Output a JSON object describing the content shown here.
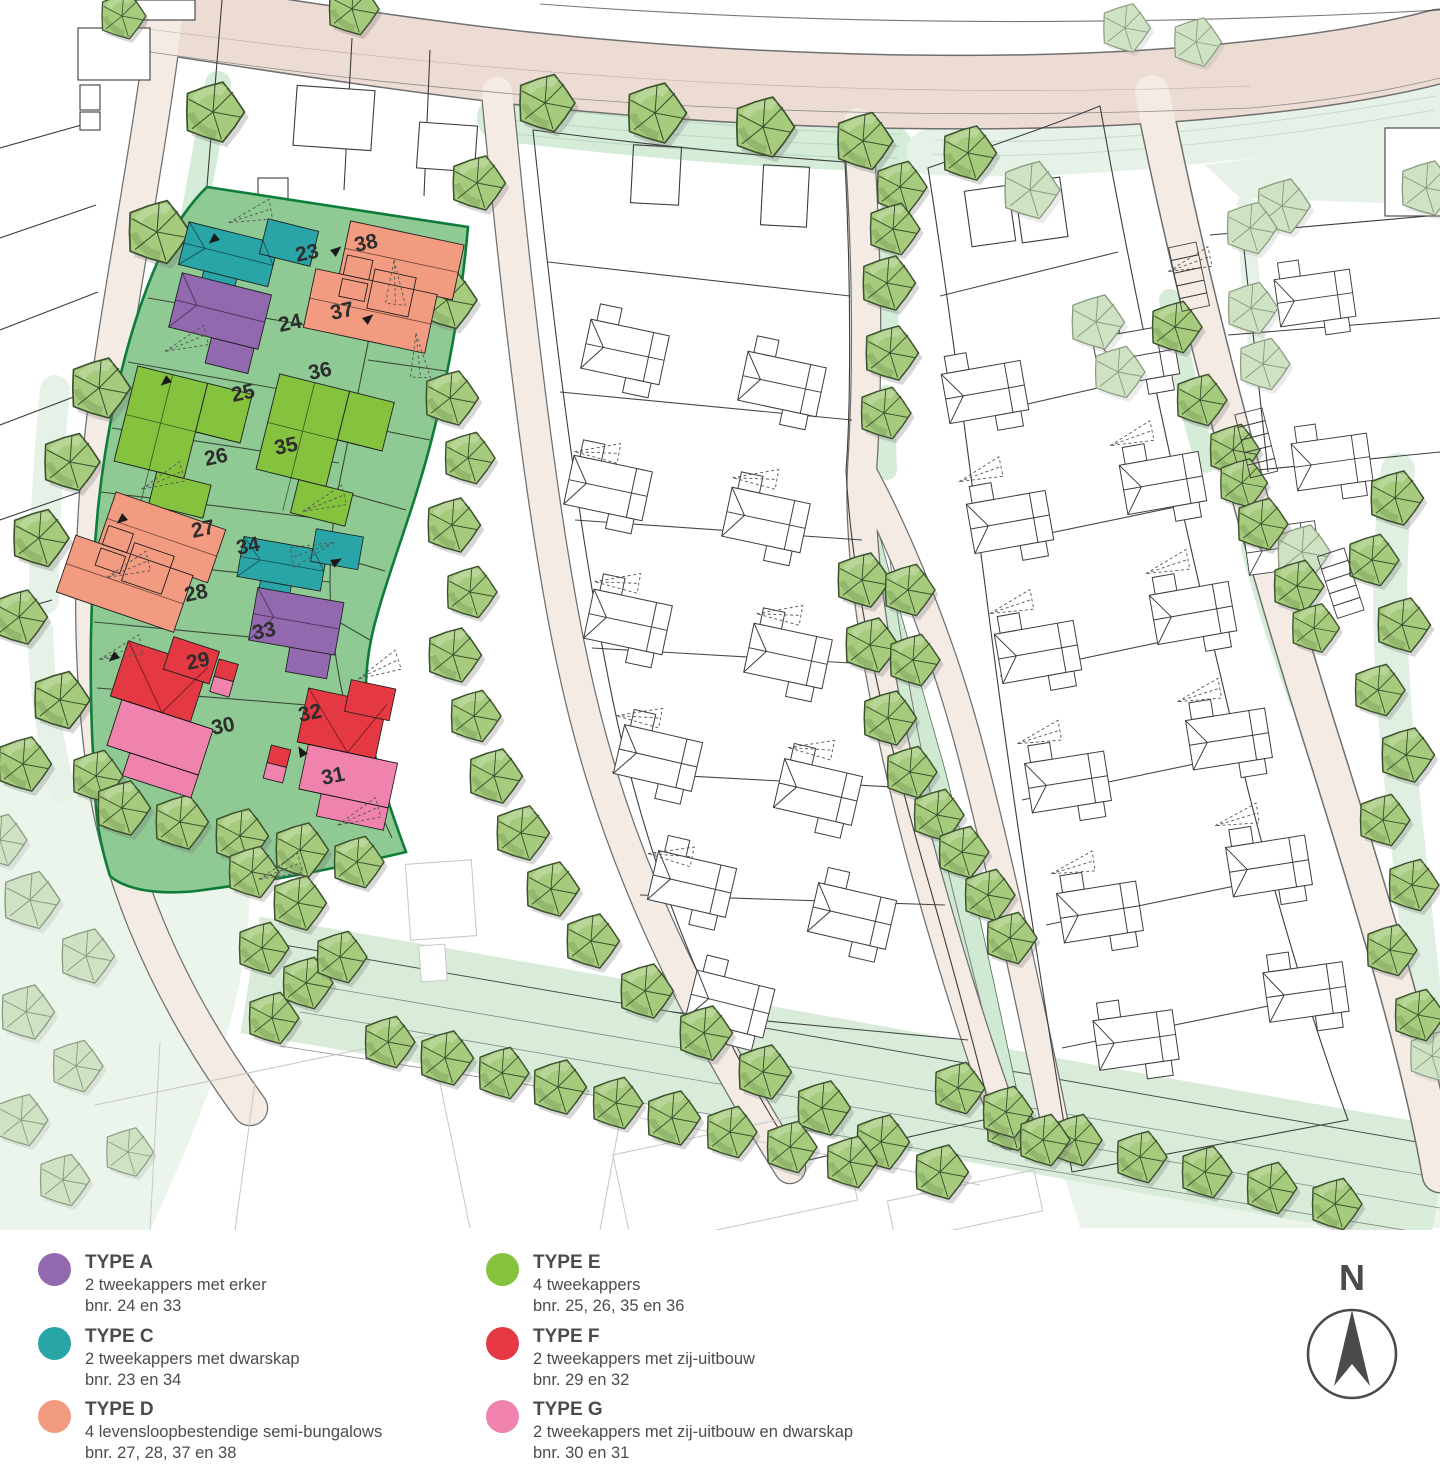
{
  "map": {
    "colors": {
      "type_a": "#9268af",
      "type_c": "#29a5a8",
      "type_d": "#f29b80",
      "type_e": "#85c23e",
      "type_f": "#e43843",
      "type_g": "#f083ae",
      "parcel": "#8fc993",
      "parcel_border": "#0e7c3a",
      "tree": "#a6cb7d",
      "tree_pale": "#d0e2c4",
      "road_main": "#eddcd4",
      "road": "#f4ebe5",
      "verge": "#d5ecd8",
      "verge_pale": "#e6f2e7",
      "corridor": "#d9ecd9",
      "park": "#cfe9d2",
      "bg_pale": "#ecf5ec"
    },
    "lot_numbers": [
      {
        "n": "23",
        "x": 297,
        "y": 262,
        "r": -12
      },
      {
        "n": "24",
        "x": 280,
        "y": 332,
        "r": -12
      },
      {
        "n": "25",
        "x": 233,
        "y": 402,
        "r": -12
      },
      {
        "n": "26",
        "x": 206,
        "y": 466,
        "r": -12
      },
      {
        "n": "27",
        "x": 193,
        "y": 538,
        "r": -12
      },
      {
        "n": "28",
        "x": 186,
        "y": 602,
        "r": -12
      },
      {
        "n": "29",
        "x": 188,
        "y": 670,
        "r": -12
      },
      {
        "n": "30",
        "x": 213,
        "y": 735,
        "r": -12
      },
      {
        "n": "31",
        "x": 323,
        "y": 785,
        "r": -12
      },
      {
        "n": "32",
        "x": 300,
        "y": 722,
        "r": -12
      },
      {
        "n": "33",
        "x": 254,
        "y": 640,
        "r": -12
      },
      {
        "n": "34",
        "x": 238,
        "y": 555,
        "r": -12
      },
      {
        "n": "35",
        "x": 276,
        "y": 455,
        "r": -12
      },
      {
        "n": "36",
        "x": 310,
        "y": 380,
        "r": -12
      },
      {
        "n": "37",
        "x": 332,
        "y": 320,
        "r": -12
      },
      {
        "n": "38",
        "x": 356,
        "y": 252,
        "r": -12
      }
    ],
    "trees_bright": [
      [
        545,
        103,
        1
      ],
      [
        655,
        113,
        1.05
      ],
      [
        763,
        127,
        1.05
      ],
      [
        863,
        141,
        1
      ],
      [
        968,
        153,
        0.95
      ],
      [
        122,
        16,
        0.8
      ],
      [
        352,
        9,
        0.9
      ],
      [
        213,
        112,
        1.05
      ],
      [
        157,
        232,
        1.1
      ],
      [
        99,
        388,
        1.05
      ],
      [
        70,
        462,
        1
      ],
      [
        39,
        538,
        1
      ],
      [
        19,
        617,
        0.95
      ],
      [
        60,
        700,
        1
      ],
      [
        23,
        764,
        0.95
      ],
      [
        96,
        776,
        0.9
      ],
      [
        122,
        808,
        0.95
      ],
      [
        180,
        822,
        0.95
      ],
      [
        240,
        836,
        0.95
      ],
      [
        300,
        850,
        0.95
      ],
      [
        357,
        862,
        0.9
      ],
      [
        477,
        183,
        0.95
      ],
      [
        447,
        300,
        1
      ],
      [
        450,
        398,
        0.95
      ],
      [
        468,
        458,
        0.9
      ],
      [
        452,
        525,
        0.95
      ],
      [
        470,
        592,
        0.9
      ],
      [
        453,
        655,
        0.95
      ],
      [
        474,
        716,
        0.9
      ],
      [
        494,
        776,
        0.95
      ],
      [
        521,
        833,
        0.95
      ],
      [
        551,
        889,
        0.95
      ],
      [
        591,
        941,
        0.95
      ],
      [
        645,
        991,
        0.95
      ],
      [
        704,
        1033,
        0.95
      ],
      [
        763,
        1072,
        0.95
      ],
      [
        822,
        1108,
        0.95
      ],
      [
        881,
        1142,
        0.95
      ],
      [
        940,
        1172,
        0.95
      ],
      [
        252,
        872,
        0.9
      ],
      [
        298,
        903,
        0.95
      ],
      [
        262,
        948,
        0.9
      ],
      [
        306,
        983,
        0.9
      ],
      [
        272,
        1018,
        0.9
      ],
      [
        340,
        957,
        0.9
      ],
      [
        388,
        1042,
        0.9
      ],
      [
        445,
        1058,
        0.95
      ],
      [
        502,
        1073,
        0.9
      ],
      [
        558,
        1087,
        0.95
      ],
      [
        616,
        1103,
        0.9
      ],
      [
        672,
        1118,
        0.95
      ],
      [
        730,
        1132,
        0.9
      ],
      [
        790,
        1147,
        0.9
      ],
      [
        850,
        1162,
        0.9
      ],
      [
        1010,
        1125,
        0.9
      ],
      [
        1075,
        1140,
        0.9
      ],
      [
        1140,
        1157,
        0.9
      ],
      [
        1205,
        1172,
        0.9
      ],
      [
        1270,
        1188,
        0.9
      ],
      [
        1335,
        1204,
        0.9
      ],
      [
        900,
        187,
        0.9
      ],
      [
        893,
        229,
        0.9
      ],
      [
        887,
        283,
        0.95
      ],
      [
        890,
        353,
        0.95
      ],
      [
        884,
        413,
        0.9
      ],
      [
        862,
        580,
        0.95
      ],
      [
        908,
        590,
        0.9
      ],
      [
        870,
        645,
        0.95
      ],
      [
        913,
        660,
        0.9
      ],
      [
        888,
        718,
        0.95
      ],
      [
        910,
        772,
        0.9
      ],
      [
        937,
        815,
        0.9
      ],
      [
        962,
        852,
        0.9
      ],
      [
        988,
        895,
        0.9
      ],
      [
        1010,
        938,
        0.9
      ],
      [
        958,
        1088,
        0.9
      ],
      [
        1006,
        1112,
        0.9
      ],
      [
        1043,
        1140,
        0.9
      ],
      [
        1175,
        327,
        0.9
      ],
      [
        1200,
        400,
        0.9
      ],
      [
        1233,
        450,
        0.9
      ],
      [
        1242,
        483,
        0.85
      ],
      [
        1261,
        524,
        0.9
      ],
      [
        1297,
        586,
        0.9
      ],
      [
        1314,
        628,
        0.85
      ],
      [
        1395,
        498,
        0.95
      ],
      [
        1372,
        560,
        0.9
      ],
      [
        1402,
        625,
        0.95
      ],
      [
        1378,
        690,
        0.9
      ],
      [
        1406,
        755,
        0.95
      ],
      [
        1383,
        820,
        0.9
      ],
      [
        1412,
        885,
        0.9
      ],
      [
        1390,
        950,
        0.9
      ],
      [
        1418,
        1015,
        0.9
      ]
    ],
    "trees_pale": [
      [
        1030,
        190,
        1
      ],
      [
        1282,
        206,
        0.95
      ],
      [
        1426,
        188,
        0.95
      ],
      [
        1125,
        28,
        0.85
      ],
      [
        1196,
        42,
        0.85
      ],
      [
        1250,
        228,
        0.9
      ],
      [
        1251,
        308,
        0.9
      ],
      [
        1263,
        364,
        0.9
      ],
      [
        1302,
        552,
        0.95
      ],
      [
        1096,
        322,
        0.95
      ],
      [
        1118,
        372,
        0.9
      ],
      [
        30,
        900,
        1
      ],
      [
        86,
        956,
        0.95
      ],
      [
        26,
        1012,
        0.95
      ],
      [
        76,
        1066,
        0.9
      ],
      [
        21,
        1120,
        0.9
      ],
      [
        63,
        1180,
        0.9
      ],
      [
        128,
        1152,
        0.85
      ],
      [
        0,
        840,
        0.9
      ],
      [
        1432,
        1056,
        0.85
      ]
    ]
  },
  "legend": {
    "items": [
      {
        "title": "TYPE A",
        "line1": "2 tweekappers met erker",
        "line2": "bnr. 24 en 33",
        "color": "#9268af"
      },
      {
        "title": "TYPE C",
        "line1": "2 tweekappers met dwarskap",
        "line2": "bnr. 23 en 34",
        "color": "#29a5a8"
      },
      {
        "title": "TYPE D",
        "line1": "4 levensloopbestendige semi-bungalows",
        "line2": "bnr. 27, 28, 37 en 38",
        "color": "#f29b80"
      },
      {
        "title": "TYPE E",
        "line1": "4 tweekappers",
        "line2": "bnr. 25, 26, 35 en 36",
        "color": "#85c23e"
      },
      {
        "title": "TYPE F",
        "line1": "2 tweekappers met zij-uitbouw",
        "line2": "bnr. 29 en 32",
        "color": "#e43843"
      },
      {
        "title": "TYPE G",
        "line1": "2 tweekappers met zij-uitbouw en dwarskap",
        "line2": "bnr. 30 en 31",
        "color": "#f083ae"
      }
    ]
  },
  "compass": {
    "label": "N"
  }
}
